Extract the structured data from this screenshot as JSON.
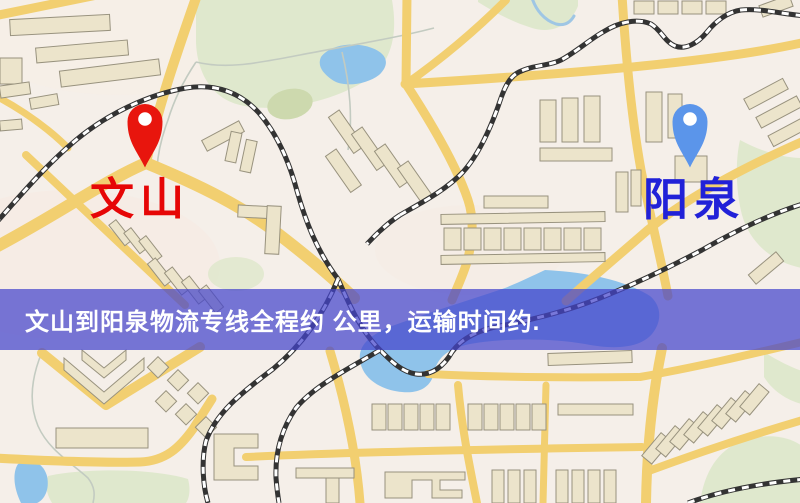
{
  "map": {
    "origin_marker": {
      "label": "文山",
      "pin_color": "#e8150d",
      "label_color": "#e60606"
    },
    "destination_marker": {
      "label": "阳泉",
      "pin_color": "#5b95ea",
      "label_color": "#2121d8"
    },
    "banner": {
      "text": "文山到阳泉物流专线全程约 公里，运输时间约.",
      "background": "rgba(68,68,204,0.72)",
      "text_color": "#ffffff"
    },
    "palette": {
      "background": "#f5efe9",
      "road": "#f2cf70",
      "building_fill": "#ece4cb",
      "building_stroke": "#98927e",
      "park_green": "#dfe8cd",
      "water_blue": "#8fc3ea",
      "railway": "#333333"
    }
  }
}
